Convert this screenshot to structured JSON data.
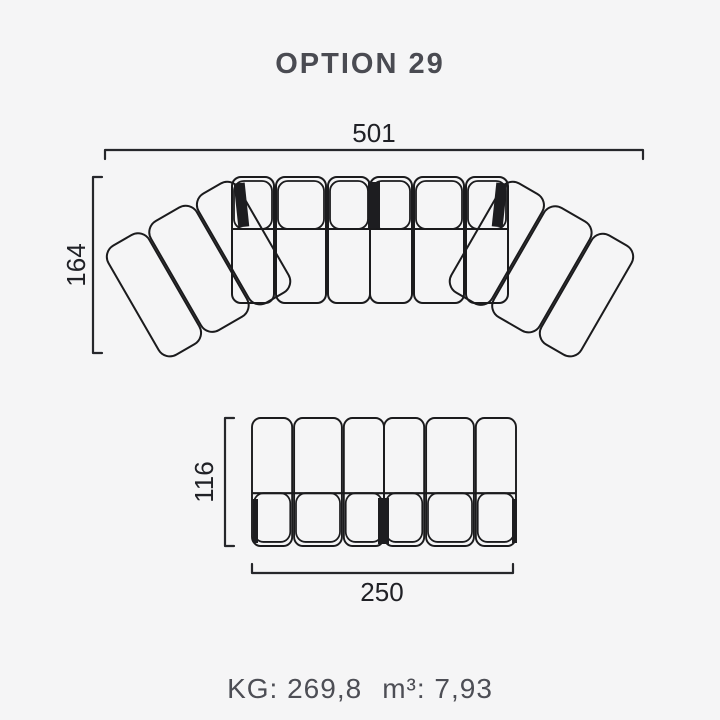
{
  "title": "OPTION 29",
  "diagram": {
    "top_view": {
      "width": "501",
      "depth": "164"
    },
    "front_unit": {
      "depth": "116",
      "width": "250"
    }
  },
  "footer": {
    "weight": "KG: 269,8",
    "volume": "m³: 7,93"
  },
  "colors": {
    "background": "#f5f5f6",
    "drawing_line": "#1b1b1d",
    "dimension_line": "#26272b",
    "dimension_text": "#202126",
    "label_text": "#4d4e55"
  }
}
